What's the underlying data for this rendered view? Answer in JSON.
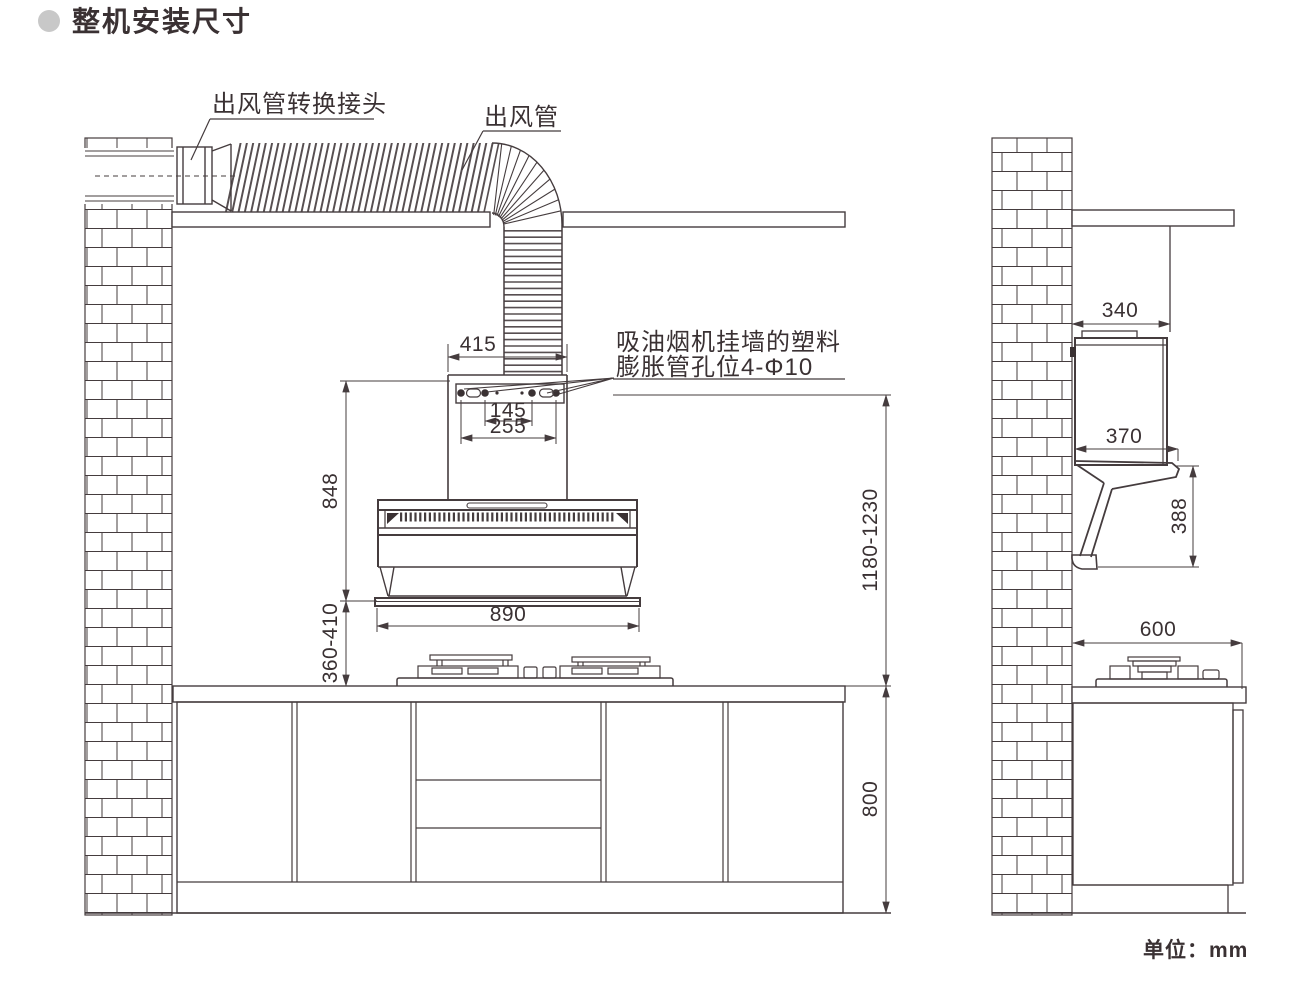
{
  "page": {
    "title": "整机安装尺寸",
    "unit_note": "单位：mm",
    "colors": {
      "line": "#453c3e",
      "text": "#3a3133",
      "title_bullet": "#c8c8c8",
      "background": "#ffffff"
    }
  },
  "front_view": {
    "labels": {
      "duct_adapter": "出风管转换接头",
      "duct": "出风管",
      "wall_holes_line1": "吸油烟机挂墙的塑料",
      "wall_holes_line2": "膨胀管孔位4-Φ10"
    },
    "dimensions": {
      "flue_cover_width": "415",
      "hole_pitch_inner": "145",
      "hole_pitch_outer": "255",
      "hood_height": "848",
      "hood_bottom_to_countertop": "360-410",
      "hood_width": "890",
      "mount_holes_to_countertop": "1180-1230",
      "countertop_height": "800"
    }
  },
  "side_view": {
    "dimensions": {
      "wall_to_duct_front": "340",
      "hood_depth": "370",
      "hood_front_height": "388",
      "countertop_depth": "600"
    }
  }
}
